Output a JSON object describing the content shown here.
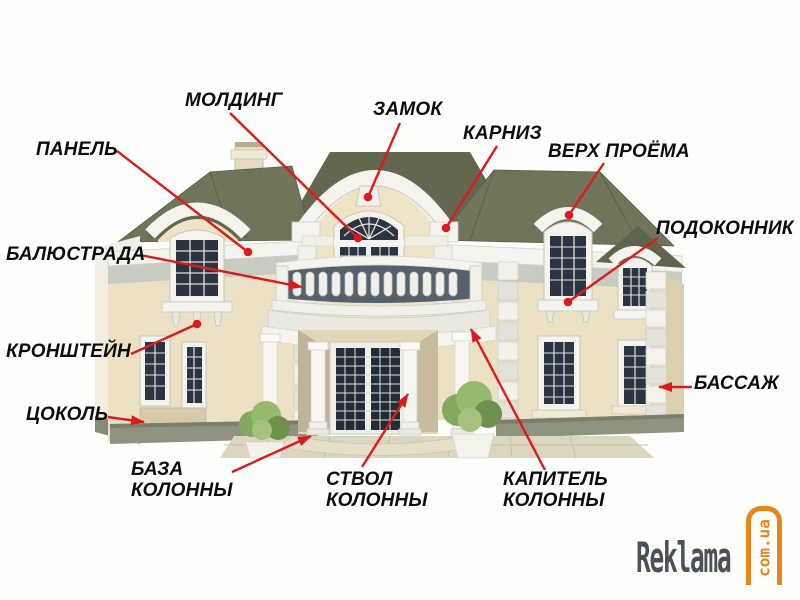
{
  "diagram": {
    "description": "Labeled architectural elements of a classical house facade",
    "labels": [
      {
        "id": "panel",
        "text": "ПАНЕЛЬ",
        "x": 36,
        "y": 139,
        "line": [
          117,
          151,
          248,
          252
        ],
        "end": "dot"
      },
      {
        "id": "moulding",
        "text": "МОЛДИНГ",
        "x": 185,
        "y": 90,
        "line": [
          230,
          113,
          358,
          238
        ],
        "end": "dot"
      },
      {
        "id": "keystone",
        "text": "ЗАМОК",
        "x": 373,
        "y": 99,
        "line": [
          400,
          123,
          368,
          197
        ],
        "end": "dot"
      },
      {
        "id": "cornice",
        "text": "КАРНИЗ",
        "x": 463,
        "y": 123,
        "line": [
          497,
          146,
          446,
          228
        ],
        "end": "dot"
      },
      {
        "id": "opening-top",
        "text": "ВЕРХ ПРОЁМА",
        "x": 548,
        "y": 141,
        "line": [
          604,
          163,
          569,
          215
        ],
        "end": "dot"
      },
      {
        "id": "windowsill",
        "text": "ПОДОКОННИК",
        "x": 656,
        "y": 218,
        "line": [
          658,
          238,
          568,
          302
        ],
        "end": "dot"
      },
      {
        "id": "balustrade",
        "text": "БАЛЮСТРАДА",
        "x": 6,
        "y": 244,
        "line": [
          140,
          255,
          302,
          287
        ],
        "end": "arrow"
      },
      {
        "id": "bracket",
        "text": "КРОНШТЕЙН",
        "x": 6,
        "y": 341,
        "line": [
          131,
          354,
          197,
          324
        ],
        "end": "dot"
      },
      {
        "id": "bossage",
        "text": "БАССАЖ",
        "x": 694,
        "y": 373,
        "line": [
          692,
          387,
          659,
          387
        ],
        "end": "arrow"
      },
      {
        "id": "plinth",
        "text": "ЦОКОЛЬ",
        "x": 26,
        "y": 404,
        "line": [
          108,
          417,
          144,
          422
        ],
        "end": "arrow"
      },
      {
        "id": "column-base",
        "text": "БАЗА\nКОЛОННЫ",
        "x": 131,
        "y": 459,
        "line": [
          232,
          472,
          311,
          436
        ],
        "end": "arrow"
      },
      {
        "id": "column-shaft",
        "text": "СТВОЛ\nКОЛОННЫ",
        "x": 326,
        "y": 469,
        "line": [
          362,
          467,
          408,
          394
        ],
        "end": "arrow"
      },
      {
        "id": "column-capital",
        "text": "КАПИТЕЛЬ\nКОЛОННЫ",
        "x": 503,
        "y": 469,
        "line": [
          545,
          470,
          471,
          329
        ],
        "end": "arrow"
      }
    ]
  },
  "watermark": {
    "name": "Reklama",
    "domain": "com.ua"
  },
  "palette": {
    "accent": "#dc1c1c",
    "label": "#0d0d0d",
    "roof": "#70745a",
    "roof_dark": "#636750",
    "wall": "#ece1c4",
    "wall_shadow": "#dfd2b2",
    "trim": "#f4f3ee",
    "trim_shadow": "#c9cbc3",
    "frieze": "#c7cbc2",
    "glass": "#2b3542",
    "plinth": "#8f927e",
    "foliage": "#85a75f",
    "watermark_text": "#4a5158",
    "watermark_accent": "#e8861a"
  }
}
